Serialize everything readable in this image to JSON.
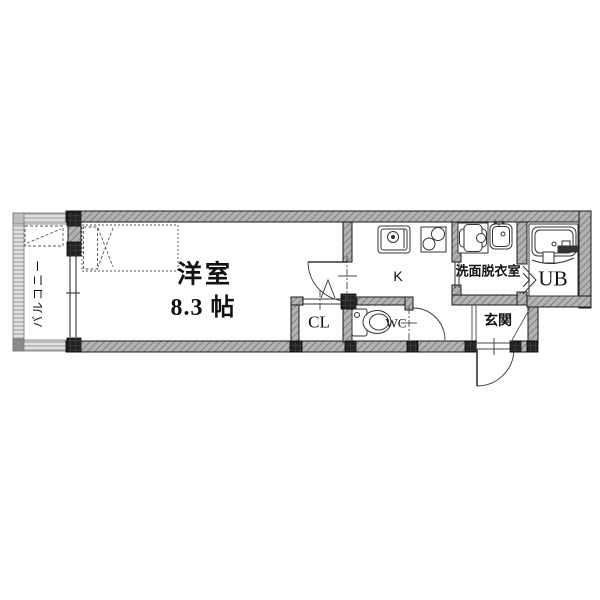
{
  "plan": {
    "balcony_label": "バルコニー",
    "room_name": "洋室",
    "room_size": "8.3 帖",
    "closet_label": "CL",
    "toilet_label": "WC",
    "kitchen_label": "K",
    "washroom_label": "洗面脱衣室",
    "bath_label": "UB",
    "entrance_label": "玄関"
  },
  "colors": {
    "bg": "#ffffff",
    "wall_fill": "#b2b2b2",
    "wall_hatch": "#6b6b6b",
    "wall_outline": "#1a1a1a",
    "light_wall_fill": "#e0e0e0",
    "light_wall_hatch": "#9a9a9a",
    "post_fill": "#232323",
    "line_color": "#333333",
    "text_color": "#111111"
  }
}
